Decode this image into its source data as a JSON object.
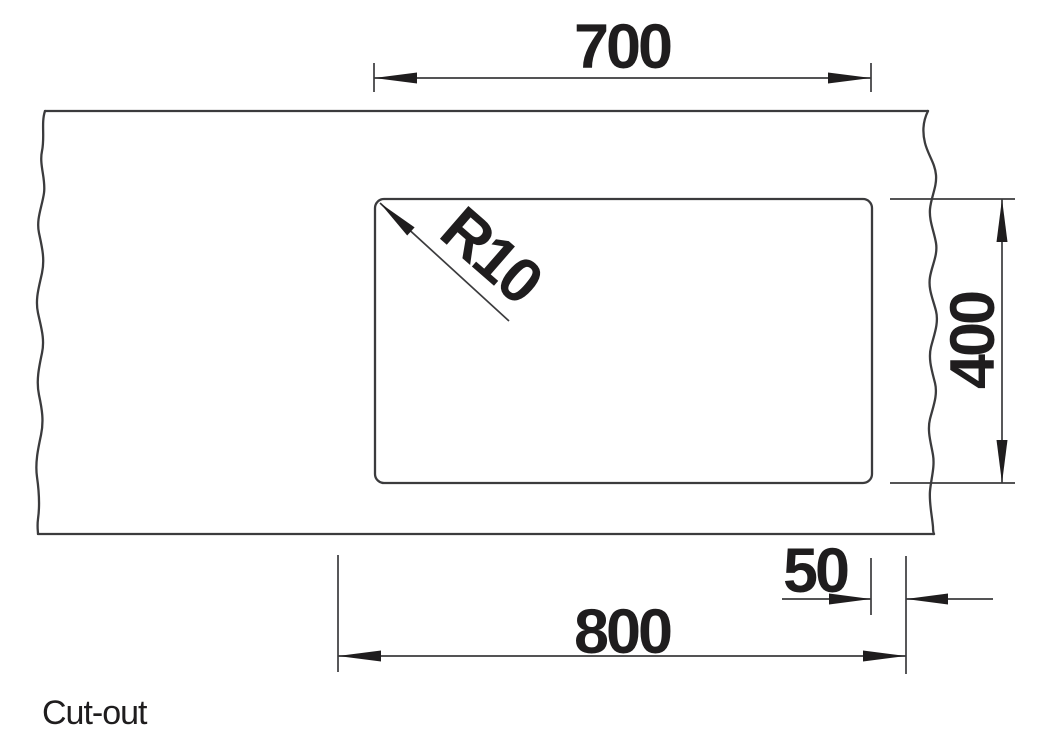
{
  "caption": "Cut-out",
  "drawing": {
    "dims": {
      "top_width": "700",
      "side_height": "400",
      "edge_offset": "50",
      "bottom_width": "800",
      "corner_radius": "R10"
    }
  },
  "colors": {
    "background": "#ffffff",
    "line": "#3b3b3d",
    "ink": "#1f1d1e"
  }
}
